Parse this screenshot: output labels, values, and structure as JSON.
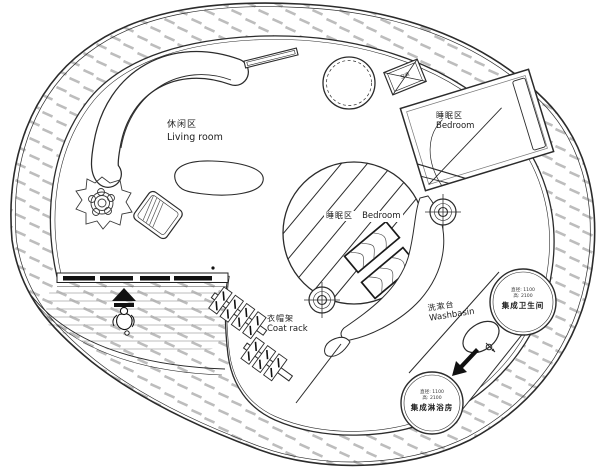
{
  "areas": {
    "living": {
      "zh": "休闲区",
      "en": "Living room"
    },
    "bedroom_upper": {
      "zh": "睡眠区",
      "en": "Bedroom"
    },
    "bedroom_center": {
      "zh": "睡眠区",
      "en": "Bedroom"
    },
    "coat_rack": {
      "zh": "衣帽架",
      "en": "Coat rack"
    },
    "washbasin": {
      "zh": "洗漱台",
      "en": "Washbasin"
    }
  },
  "pods": {
    "bathroom": {
      "spec_line1": "直径: 1100",
      "spec_line2": "高: 2100",
      "name": "集成卫生间"
    },
    "shower": {
      "spec_line1": "直径: 1100",
      "spec_line2": "高: 2100",
      "name": "集成淋浴房"
    }
  },
  "equipment": {
    "ac": "空调"
  },
  "icons": {
    "plant": "plant-top-view-icon",
    "person": "person-top-view-icon",
    "entry_arrow": "entry-arrow-icon",
    "downlight": "crosshair-target-icon",
    "ac_unit": "crossed-box-ac-icon",
    "faucet": "faucet-icon"
  },
  "colors": {
    "line": "#2b2b2b",
    "line_light": "#666666",
    "hatch": "#bdbdbd",
    "panel_dark": "#111111",
    "bg": "#ffffff"
  }
}
